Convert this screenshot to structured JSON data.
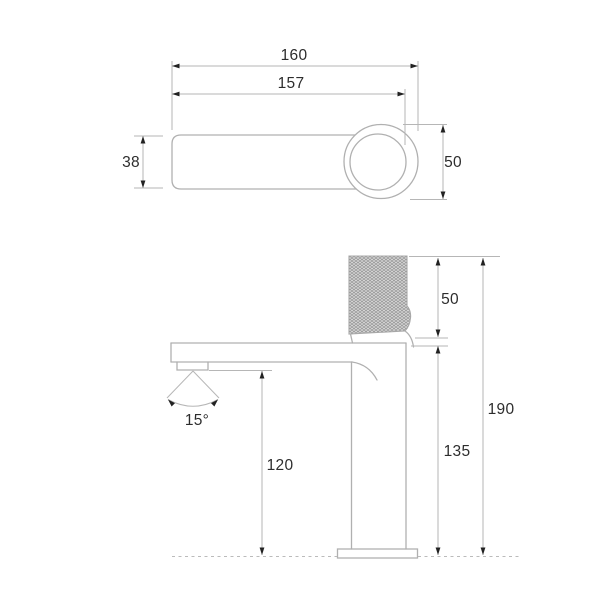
{
  "drawing": {
    "type": "technical-dimension-drawing",
    "subject": "single-lever basin faucet, top view and side view",
    "top_view": {
      "total_length_mm": "160",
      "lever_reach_mm": "157",
      "lever_width_mm": "38",
      "body_diameter_mm": "50"
    },
    "side_view": {
      "handle_section_height_mm": "50",
      "total_height_mm": "190",
      "body_height_mm": "135",
      "spout_outlet_height_mm": "120",
      "spray_angle": "15°"
    },
    "colors": {
      "background": "#ffffff",
      "outline": "#b0b0b0",
      "dimension_line": "#b6b6b6",
      "arrow": "#222222",
      "text": "#2d2d2d",
      "knurl_fill": "#d6d6d6",
      "knurl_hatch": "#8e8e8e"
    }
  }
}
